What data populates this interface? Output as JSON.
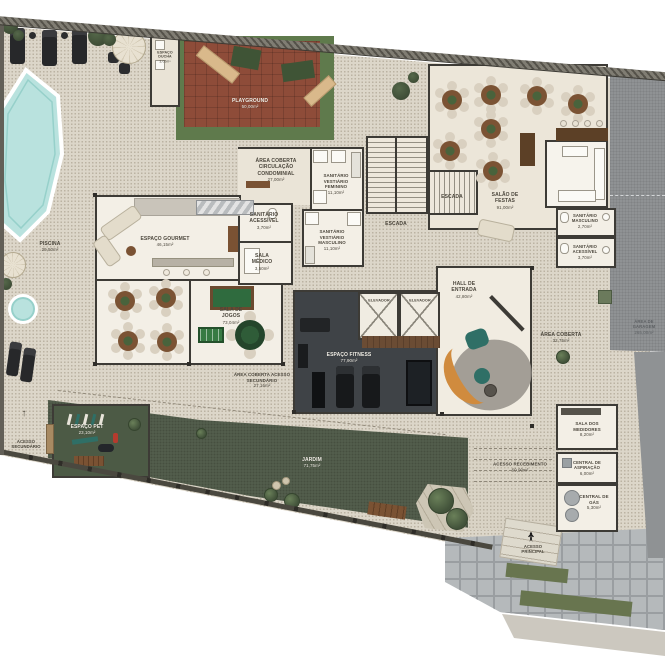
{
  "plan_type": "condominium ground floor / leisure area floor plan",
  "colors": {
    "wall": "#3d3b36",
    "deck": "#dcd6c9",
    "garden": "#55604e",
    "pool_water": "#b9e2de",
    "playground_rubber": "#8e4c39",
    "fitness_floor": "#3f4347",
    "garage_paving": "#8f9294",
    "wood_furniture": "#7b5334",
    "teal_furniture": "#2f6f66",
    "orange_furniture": "#d08b3e"
  },
  "labels": {
    "piscina": {
      "name": "PISCINA",
      "area": "29,50m²"
    },
    "espaco_ducha": {
      "name": "ESPAÇO DUCHA",
      "area": "3,05m²"
    },
    "playground": {
      "name": "PLAYGROUND",
      "area": "50,00m²"
    },
    "circulacao": {
      "name": "ÁREA COBERTA CIRCULAÇÃO CONDOMINIAL",
      "area": "27,00m²"
    },
    "sanitario_acessivel": {
      "name": "SANITÁRIO ACESSÍVEL",
      "area": "3,70m²"
    },
    "sala_medico": {
      "name": "SALA MÉDICO",
      "area": "3,50m²"
    },
    "espaco_gourmet": {
      "name": "ESPAÇO GOURMET",
      "area": "46,15m²"
    },
    "vestiario_feminino": {
      "name": "SANITÁRIO VESTIÁRIO FEMININO",
      "area": "11,10m²"
    },
    "vestiario_masculino": {
      "name": "SANITÁRIO VESTIÁRIO MASCULINO",
      "area": "11,10m²"
    },
    "escada": {
      "name": "ESCADA"
    },
    "salao_festas": {
      "name": "SALÃO DE FESTAS",
      "area": "91,00m²"
    },
    "sanitario_masculino": {
      "name": "SANITÁRIO MASCULINO",
      "area": "2,70m²"
    },
    "elevador": {
      "name": "ELEVADOR"
    },
    "hall_entrada": {
      "name": "HALL DE ENTRADA",
      "area": "42,80m²"
    },
    "espaco_fitness": {
      "name": "ESPAÇO FITNESS",
      "area": "77,90m²"
    },
    "area_coberta": {
      "name": "ÁREA COBERTA",
      "area": "32,75m²"
    },
    "sala_jogos": {
      "name": "SALA DE JOGOS",
      "area": "73,04m²"
    },
    "area_coberta_acesso": {
      "name": "ÁREA COBERTA ACESSO SECUNDÁRIO",
      "area": "27,16m²"
    },
    "espaco_pet": {
      "name": "ESPAÇO PET",
      "area": "23,10m²"
    },
    "acesso_secundario": {
      "name": "ACESSO SECUNDÁRIO"
    },
    "jardim": {
      "name": "JARDIM",
      "area": "71,75m²"
    },
    "acesso_recebimento": {
      "name": "ACESSO RECEBIMENTO",
      "area": "60,00m²"
    },
    "sala_medidores": {
      "name": "SALA DOS MEDIDORES",
      "area": "8,20m²"
    },
    "central_aspiracao": {
      "name": "CENTRAL DE ASPIRAÇÃO",
      "area": "6,00m²"
    },
    "central_gas": {
      "name": "CENTRAL DE GÁS",
      "area": "5,30m²"
    },
    "acesso_principal": {
      "name": "ACESSO PRINCIPAL"
    },
    "area_garagem": {
      "name": "ÁREA DE GARAGEM",
      "area": "265,00m²"
    }
  },
  "icons": {
    "arrow_up": "↑"
  }
}
